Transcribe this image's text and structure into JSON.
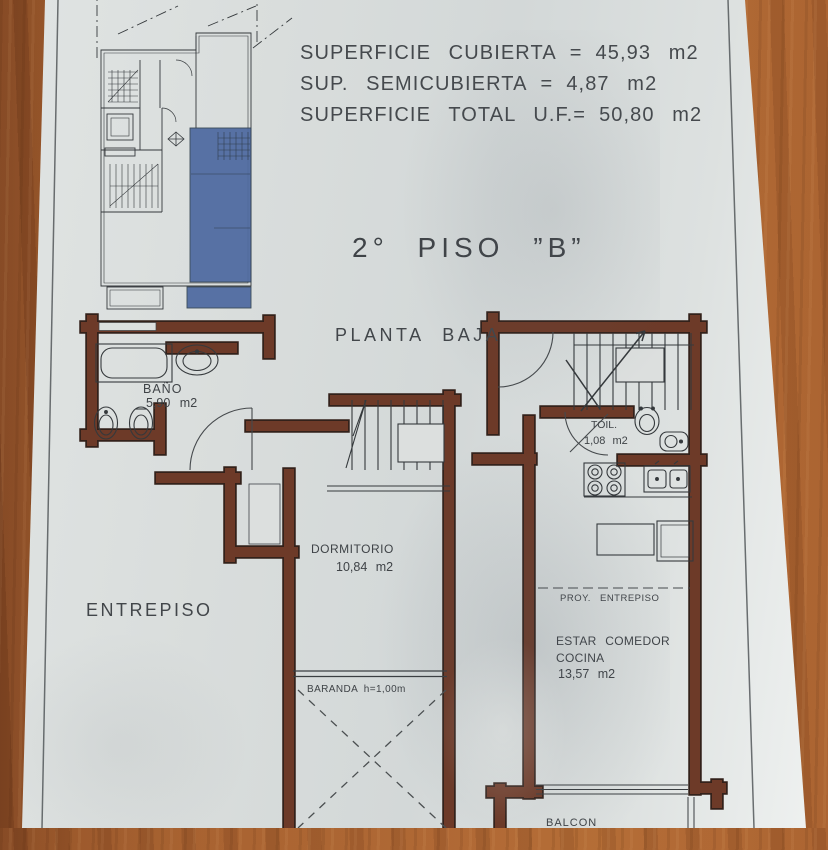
{
  "palette": {
    "paper": "#dcdfde",
    "wood": "#a8622f",
    "wall": "#6d3a28",
    "wall_edge": "#33211a",
    "highlight_unit_blue": "#4e69a0",
    "ink": "#3f4347"
  },
  "areas": {
    "lines": [
      {
        "l": "SUPERFICIE CUBIERTA",
        "eq": "=",
        "v": "45,93 m2"
      },
      {
        "l": "SUP. SEMICUBIERTA",
        "eq": "=",
        "v": "4,87 m2"
      },
      {
        "l": "SUPERFICIE TOTAL U.F.=",
        "eq": "",
        "v": "50,80 m2"
      }
    ]
  },
  "title": "2° PISO ”B”",
  "key_plan": {
    "caption": "PLANTA BAJA"
  },
  "entrepiso": {
    "label": "ENTREPISO",
    "bano": {
      "name": "BAÑO",
      "area": "5,90 m2"
    },
    "dormitorio": {
      "name": "DORMITORIO",
      "area": "10,84 m2"
    },
    "baranda": "BARANDA h=1,00m"
  },
  "piso_b": {
    "toil": {
      "name": "TOIL.",
      "area": "1,08 m2"
    },
    "proy": "PROY. ENTREPISO",
    "estar": {
      "line1": "ESTAR COMEDOR",
      "line2": "COCINA",
      "area": "13,57 m2"
    },
    "balcon": "BALCON"
  }
}
